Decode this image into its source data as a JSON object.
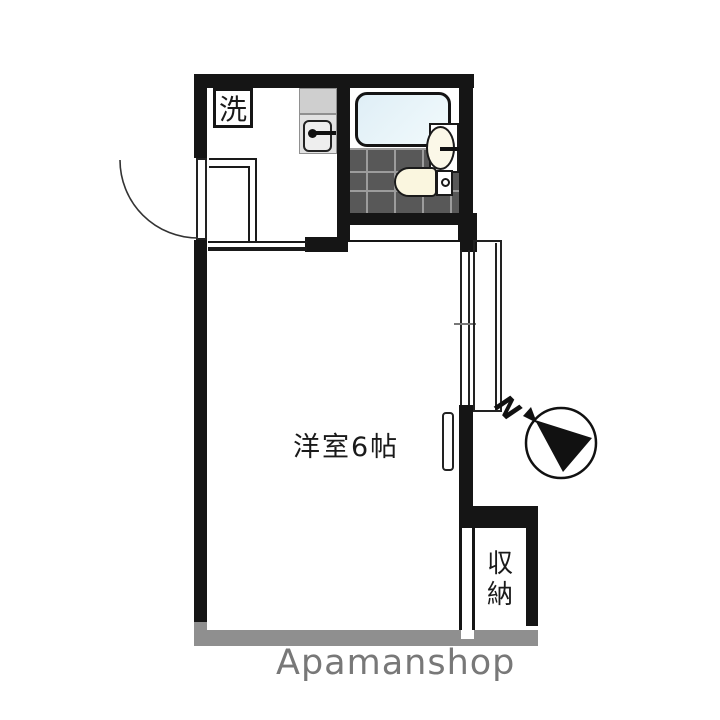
{
  "labels": {
    "laundry": "洗",
    "main_room": "洋室6帖",
    "closet": "収納",
    "compass_north": "N",
    "watermark": "Apamanshop"
  },
  "icons": {
    "compass_needle": "filled-triangle-in-circle",
    "north_arrow": "arrowhead-toward-circle",
    "kitchen_faucet": "dot-with-bar",
    "basin_faucet": "bar",
    "door_swing": "quarter-arc"
  },
  "colors": {
    "wall": "#151515",
    "gray-wall": "#8f8f8f",
    "watermark": "#787878",
    "tile-floor": "#585858",
    "tile-grout": "#9c9c9c",
    "tub-fill": "#e4f1f7",
    "fixture-cream": "#faf6df",
    "counter-gray": "#cfcfcf"
  }
}
